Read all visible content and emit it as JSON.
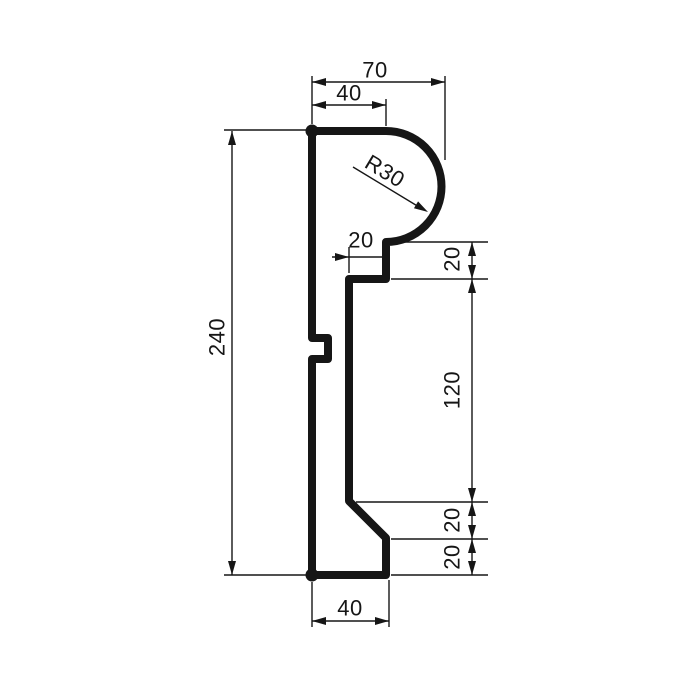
{
  "drawing": {
    "kind": "technical-profile-cross-section",
    "background": "#ffffff",
    "line_color": "#161616",
    "profile_stroke_width": 8,
    "dimension_stroke_width": 1.4,
    "arrow_length": 14,
    "arrow_half_width": 4,
    "profile": {
      "path": "M 312 131 L 386 131 A 55.5 55.5 0 0 1 386 242 L 386 279 L 349 279 L 349 501 L 386 538 L 386 575 L 312 575 L 312 359 L 328 359 L 328 338 L 312 338 Z",
      "corner_dots": [
        [
          312,
          131
        ],
        [
          312,
          575
        ]
      ],
      "dot_radius": 6.5
    },
    "dimensions": [
      {
        "id": "width-top-70",
        "label": "70",
        "label_pos": [
          375,
          70
        ],
        "label_rot": 0,
        "lines": [
          [
            312,
            76,
            312,
            124
          ],
          [
            445,
            76,
            445,
            160
          ],
          [
            312,
            82,
            445,
            82
          ]
        ],
        "arrows": [
          [
            312,
            82,
            180
          ],
          [
            445,
            82,
            0
          ]
        ]
      },
      {
        "id": "width-top-40",
        "label": "40",
        "label_pos": [
          349,
          93
        ],
        "label_rot": 0,
        "lines": [
          [
            386,
            99,
            386,
            126
          ],
          [
            312,
            105,
            386,
            105
          ]
        ],
        "arrows": [
          [
            312,
            105,
            180
          ],
          [
            386,
            105,
            0
          ]
        ]
      },
      {
        "id": "radius-R30",
        "label": "R30",
        "label_pos": [
          385,
          171
        ],
        "label_rot": 31,
        "lines": [
          [
            353,
            167,
            424,
            210
          ]
        ],
        "arrows": [
          [
            428,
            212,
            31
          ]
        ]
      },
      {
        "id": "step-width-20",
        "label": "20",
        "label_pos": [
          361,
          240
        ],
        "label_rot": 0,
        "lines": [
          [
            349,
            247,
            349,
            273
          ],
          [
            332,
            257,
            384,
            257
          ]
        ],
        "arrows": [
          [
            349,
            257,
            0
          ]
        ]
      },
      {
        "id": "step-height-20",
        "label": "20",
        "label_pos": [
          452,
          259
        ],
        "label_rot": -90,
        "lines": [
          [
            391,
            242,
            488,
            242
          ],
          [
            391,
            279,
            488,
            279
          ],
          [
            472,
            242,
            472,
            279
          ]
        ],
        "arrows": [
          [
            472,
            242,
            -90
          ],
          [
            472,
            279,
            90
          ]
        ]
      },
      {
        "id": "height-120",
        "label": "120",
        "label_pos": [
          452,
          390
        ],
        "label_rot": -90,
        "lines": [
          [
            356,
            502,
            488,
            502
          ],
          [
            472,
            279,
            472,
            502
          ]
        ],
        "arrows": [
          [
            472,
            279,
            -90
          ],
          [
            472,
            502,
            90
          ]
        ]
      },
      {
        "id": "bevel-height-20",
        "label": "20",
        "label_pos": [
          452,
          520
        ],
        "label_rot": -90,
        "lines": [
          [
            391,
            539,
            488,
            539
          ],
          [
            472,
            502,
            472,
            539
          ]
        ],
        "arrows": [
          [
            472,
            502,
            -90
          ],
          [
            472,
            539,
            90
          ]
        ]
      },
      {
        "id": "base-height-20",
        "label": "20",
        "label_pos": [
          452,
          557
        ],
        "label_rot": -90,
        "lines": [
          [
            391,
            575,
            488,
            575
          ],
          [
            472,
            539,
            472,
            575
          ]
        ],
        "arrows": [
          [
            472,
            539,
            -90
          ],
          [
            472,
            575,
            90
          ]
        ]
      },
      {
        "id": "total-height-240",
        "label": "240",
        "label_pos": [
          217,
          337
        ],
        "label_rot": -90,
        "lines": [
          [
            224,
            130,
            306,
            130
          ],
          [
            224,
            575,
            306,
            575
          ],
          [
            232,
            131,
            232,
            575
          ]
        ],
        "arrows": [
          [
            232,
            131,
            -90
          ],
          [
            232,
            575,
            90
          ]
        ]
      },
      {
        "id": "width-bottom-40",
        "label": "40",
        "label_pos": [
          350,
          608
        ],
        "label_rot": 0,
        "lines": [
          [
            312,
            582,
            312,
            627
          ],
          [
            389,
            580,
            389,
            627
          ],
          [
            312,
            621,
            389,
            621
          ]
        ],
        "arrows": [
          [
            312,
            621,
            180
          ],
          [
            389,
            621,
            0
          ]
        ]
      }
    ]
  }
}
